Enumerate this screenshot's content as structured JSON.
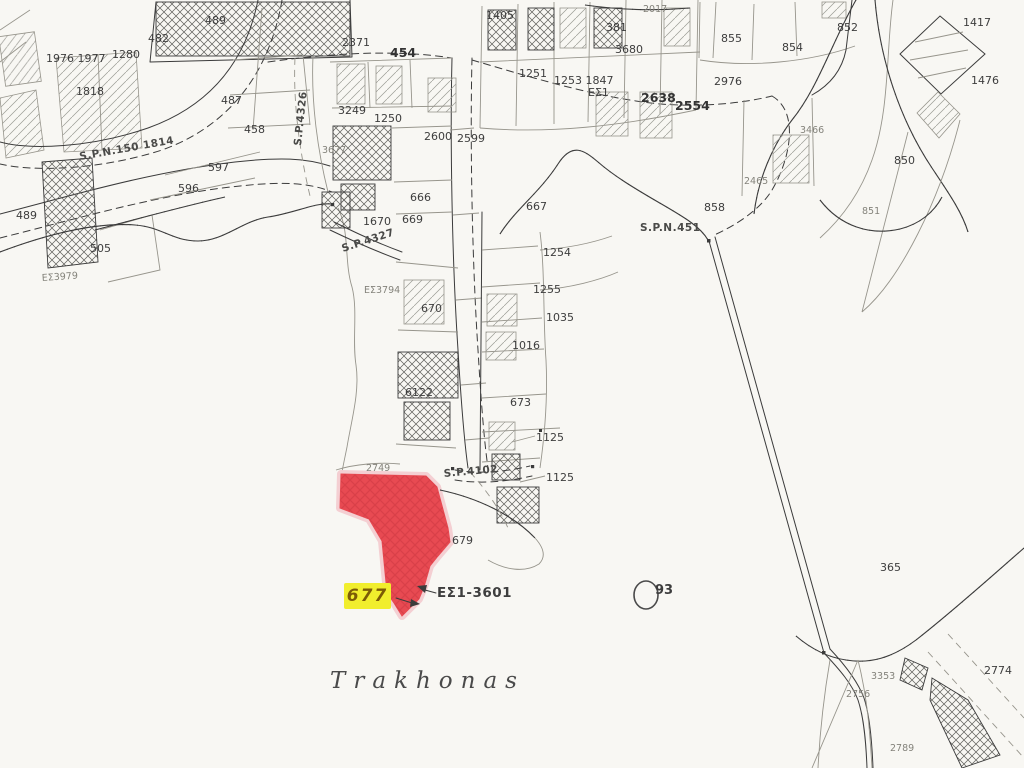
{
  "map": {
    "title": "Trakhonas",
    "highlight": {
      "plot_label": "677",
      "reference": "ΕΣ1-3601",
      "circle_label": "93"
    },
    "colors": {
      "paper": "#f8f7f3",
      "ink": "#3b3b3b",
      "red_fill": "#e84a52",
      "red_hatch": "#c7333e",
      "red_halo": "#f4cfd2",
      "yellow": "#f1ee2d",
      "yellow_text": "#7c5c06"
    },
    "labels": [
      {
        "text": "489",
        "x": 205,
        "y": 24
      },
      {
        "text": "482",
        "x": 148,
        "y": 42
      },
      {
        "text": "1280",
        "x": 112,
        "y": 58
      },
      {
        "text": "1976 1977",
        "x": 46,
        "y": 62
      },
      {
        "text": "1818",
        "x": 76,
        "y": 95
      },
      {
        "text": "487",
        "x": 221,
        "y": 104
      },
      {
        "text": "458",
        "x": 244,
        "y": 133
      },
      {
        "text": "S.P.N.150 1814",
        "x": 80,
        "y": 160,
        "r": -10,
        "cls": "road"
      },
      {
        "text": "597",
        "x": 208,
        "y": 171
      },
      {
        "text": "596",
        "x": 178,
        "y": 192
      },
      {
        "text": "489",
        "x": 16,
        "y": 219
      },
      {
        "text": "505",
        "x": 90,
        "y": 252
      },
      {
        "text": "ΕΣ3979",
        "x": 42,
        "y": 281,
        "r": -4,
        "cls": "sm"
      },
      {
        "text": "S.P.4326",
        "x": 301,
        "y": 146,
        "r": -84,
        "cls": "road"
      },
      {
        "text": "3677",
        "x": 322,
        "y": 153,
        "cls": "sm"
      },
      {
        "text": "2371",
        "x": 342,
        "y": 46
      },
      {
        "text": "454",
        "x": 390,
        "y": 57,
        "cls": "big"
      },
      {
        "text": "3249",
        "x": 338,
        "y": 114
      },
      {
        "text": "1250",
        "x": 374,
        "y": 122
      },
      {
        "text": "2600",
        "x": 424,
        "y": 140
      },
      {
        "text": "2599",
        "x": 457,
        "y": 142
      },
      {
        "text": "666",
        "x": 410,
        "y": 201
      },
      {
        "text": "669",
        "x": 402,
        "y": 223
      },
      {
        "text": "1670",
        "x": 363,
        "y": 225
      },
      {
        "text": "S.P.4327",
        "x": 343,
        "y": 252,
        "r": -18,
        "cls": "road"
      },
      {
        "text": "ΕΣ3794",
        "x": 364,
        "y": 293,
        "cls": "sm"
      },
      {
        "text": "670",
        "x": 421,
        "y": 312
      },
      {
        "text": "6122",
        "x": 405,
        "y": 396
      },
      {
        "text": "2749",
        "x": 366,
        "y": 471,
        "cls": "sm"
      },
      {
        "text": "S.P.4102",
        "x": 444,
        "y": 477,
        "r": -5,
        "cls": "road"
      },
      {
        "text": "1405",
        "x": 486,
        "y": 19
      },
      {
        "text": "1251",
        "x": 519,
        "y": 77
      },
      {
        "text": "1253 1847",
        "x": 554,
        "y": 84
      },
      {
        "text": "381",
        "x": 606,
        "y": 31
      },
      {
        "text": "3680",
        "x": 615,
        "y": 53
      },
      {
        "text": "2017",
        "x": 643,
        "y": 12,
        "cls": "sm"
      },
      {
        "text": "ΕΣ1",
        "x": 588,
        "y": 96
      },
      {
        "text": "2638",
        "x": 641,
        "y": 102,
        "cls": "big"
      },
      {
        "text": "2554",
        "x": 675,
        "y": 110,
        "cls": "big"
      },
      {
        "text": "855",
        "x": 721,
        "y": 42
      },
      {
        "text": "854",
        "x": 782,
        "y": 51
      },
      {
        "text": "852",
        "x": 837,
        "y": 31
      },
      {
        "text": "2976",
        "x": 714,
        "y": 85
      },
      {
        "text": "3466",
        "x": 800,
        "y": 133,
        "cls": "sm"
      },
      {
        "text": "2465",
        "x": 744,
        "y": 184,
        "cls": "sm"
      },
      {
        "text": "858",
        "x": 704,
        "y": 211
      },
      {
        "text": "S.P.N.451",
        "x": 640,
        "y": 231,
        "cls": "road"
      },
      {
        "text": "1417",
        "x": 963,
        "y": 26
      },
      {
        "text": "1476",
        "x": 971,
        "y": 84
      },
      {
        "text": "850",
        "x": 894,
        "y": 164
      },
      {
        "text": "851",
        "x": 862,
        "y": 214,
        "cls": "sm"
      },
      {
        "text": "667",
        "x": 526,
        "y": 210
      },
      {
        "text": "1254",
        "x": 543,
        "y": 256
      },
      {
        "text": "1255",
        "x": 533,
        "y": 293
      },
      {
        "text": "1035",
        "x": 546,
        "y": 321
      },
      {
        "text": "1016",
        "x": 512,
        "y": 349
      },
      {
        "text": "673",
        "x": 510,
        "y": 406
      },
      {
        "text": "1125",
        "x": 536,
        "y": 441
      },
      {
        "text": "1125",
        "x": 546,
        "y": 481
      },
      {
        "text": "679",
        "x": 452,
        "y": 544
      },
      {
        "text": "365",
        "x": 880,
        "y": 571
      },
      {
        "text": "2774",
        "x": 984,
        "y": 674
      },
      {
        "text": "3353",
        "x": 871,
        "y": 679,
        "cls": "sm"
      },
      {
        "text": "2756",
        "x": 846,
        "y": 697,
        "cls": "sm"
      },
      {
        "text": "2789",
        "x": 890,
        "y": 751,
        "cls": "sm"
      }
    ]
  }
}
